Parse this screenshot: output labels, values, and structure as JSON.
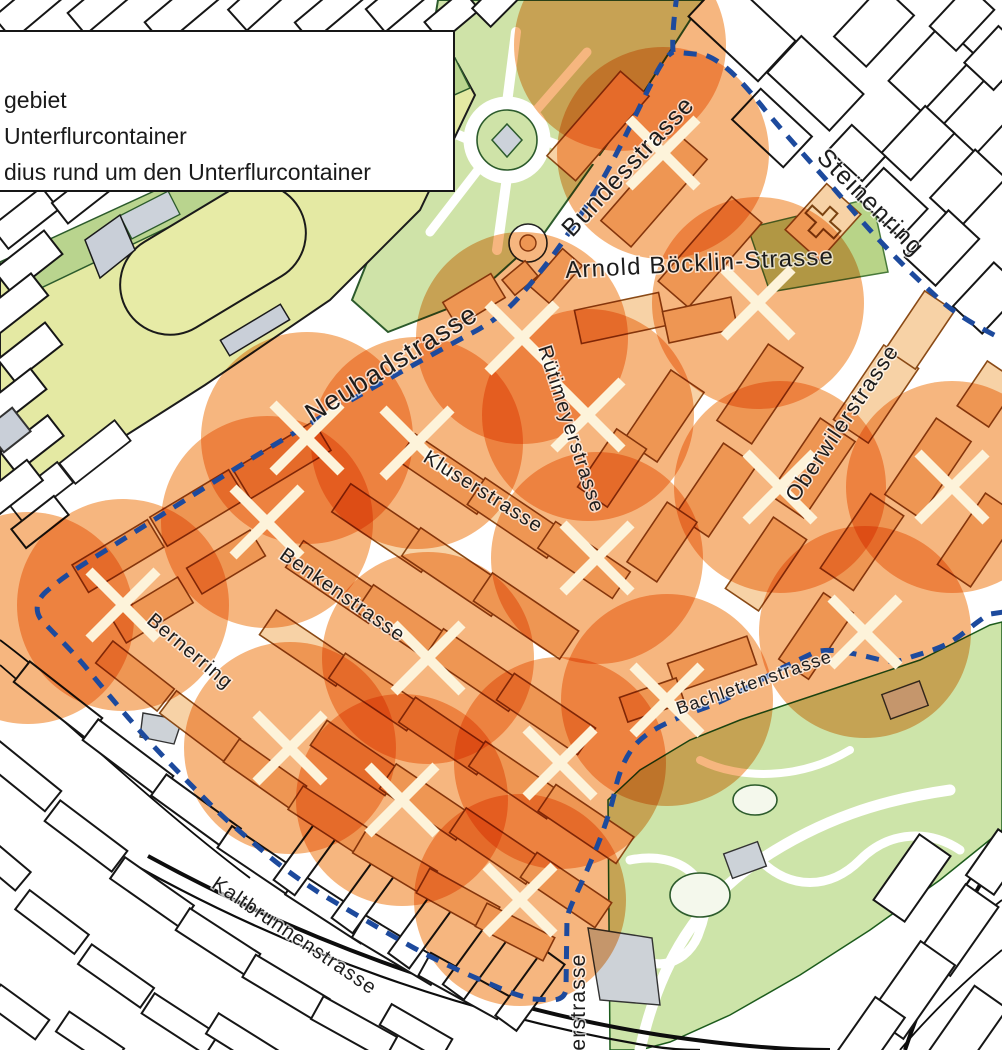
{
  "legend": {
    "items": [
      {
        "label": "gebiet"
      },
      {
        "label": "Unterflurcontainer"
      },
      {
        "label": "dius rund um den Unterflurcontainer"
      }
    ]
  },
  "map": {
    "street_labels": [
      {
        "id": "bundesstrasse",
        "text": "Bundesstrasse",
        "x": 634,
        "y": 172,
        "rotation": -47,
        "font_size": 25
      },
      {
        "id": "steinenring",
        "text": "Steinenring",
        "x": 865,
        "y": 208,
        "rotation": 45,
        "font_size": 25
      },
      {
        "id": "arnold-boecklin-strasse",
        "text": "Arnold Böcklin-Strasse",
        "x": 700,
        "y": 271,
        "rotation": -3,
        "font_size": 24
      },
      {
        "id": "neubadstrasse",
        "text": "Neubadstrasse",
        "x": 396,
        "y": 371,
        "rotation": -32,
        "font_size": 27
      },
      {
        "id": "ruetimeyerstrasse",
        "text": "Rütimeyerstrasse",
        "x": 565,
        "y": 431,
        "rotation": 72,
        "font_size": 20
      },
      {
        "id": "oberwilerstrasse",
        "text": "Oberwilerstrasse",
        "x": 848,
        "y": 427,
        "rotation": -56,
        "font_size": 22
      },
      {
        "id": "kluserstrasse",
        "text": "Kluserstrasse",
        "x": 480,
        "y": 497,
        "rotation": 32,
        "font_size": 20
      },
      {
        "id": "benkenstrasse",
        "text": "Benkenstrasse",
        "x": 339,
        "y": 600,
        "rotation": 35,
        "font_size": 20
      },
      {
        "id": "bernerring",
        "text": "Bernerring",
        "x": 186,
        "y": 656,
        "rotation": 40,
        "font_size": 20
      },
      {
        "id": "bachlettenstrasse",
        "text": "Bachlettenstrasse",
        "x": 756,
        "y": 688,
        "rotation": -19,
        "font_size": 18
      },
      {
        "id": "kaltbrunnenstrasse",
        "text": "Kaltbrunnenstrasse",
        "x": 291,
        "y": 941,
        "rotation": 34,
        "font_size": 20
      },
      {
        "id": "erstrasse",
        "text": "erstrasse",
        "x": 585,
        "y": 1002,
        "rotation": -90,
        "font_size": 21
      }
    ],
    "containers": [
      {
        "x": 663,
        "y": 153
      },
      {
        "x": 758,
        "y": 303
      },
      {
        "x": 522,
        "y": 338
      },
      {
        "x": 588,
        "y": 415
      },
      {
        "x": 307,
        "y": 438
      },
      {
        "x": 417,
        "y": 443
      },
      {
        "x": 267,
        "y": 522
      },
      {
        "x": 123,
        "y": 605
      },
      {
        "x": 597,
        "y": 558
      },
      {
        "x": 780,
        "y": 487
      },
      {
        "x": 952,
        "y": 487
      },
      {
        "x": 865,
        "y": 632
      },
      {
        "x": 428,
        "y": 658
      },
      {
        "x": 667,
        "y": 700
      },
      {
        "x": 290,
        "y": 748
      },
      {
        "x": 560,
        "y": 763
      },
      {
        "x": 402,
        "y": 800
      },
      {
        "x": 520,
        "y": 900
      }
    ],
    "partial_circles": [
      {
        "x": 620,
        "y": 45
      },
      {
        "x": 28,
        "y": 618
      }
    ],
    "radius_px": 106,
    "colors": {
      "circle": "#ef8122",
      "boundary": "#1d4a9d",
      "x_mark": "#fdf3da",
      "park_green": "#cfe3a8",
      "field_green": "#e4e9a3",
      "zoo_green": "#cde4a9",
      "building_tan": "#f7d2a6",
      "building_outline": "#8a4a16"
    }
  }
}
